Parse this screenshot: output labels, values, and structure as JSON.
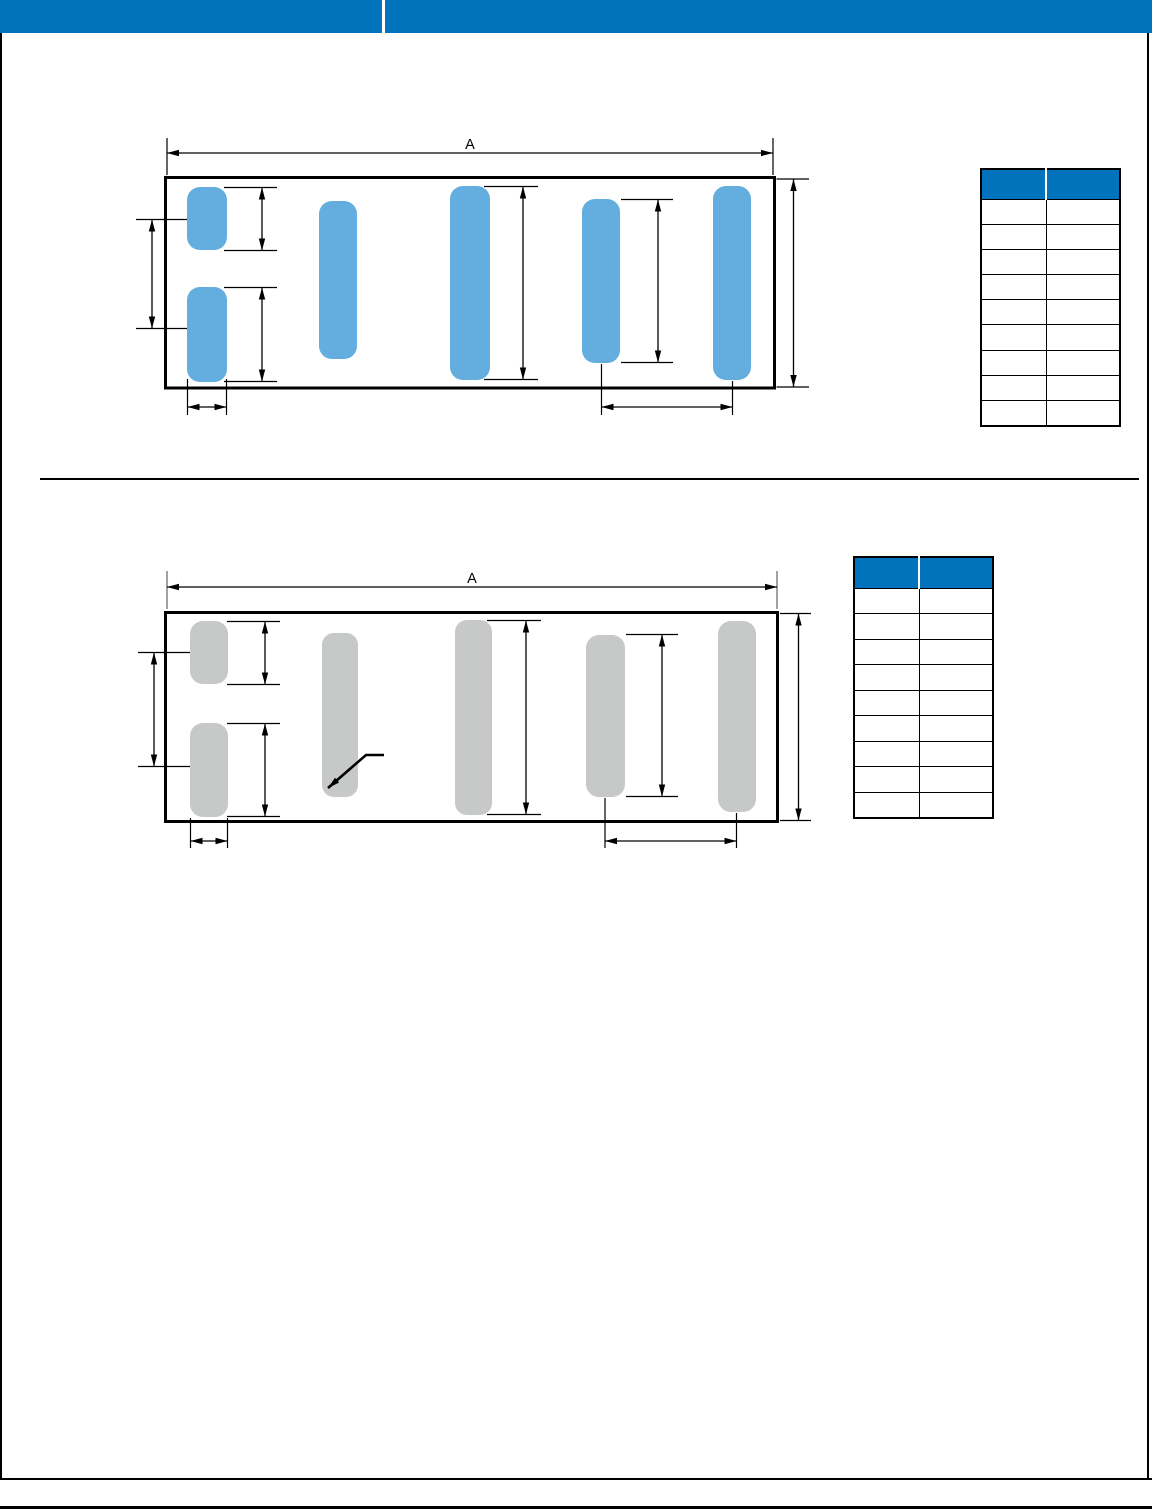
{
  "colors": {
    "brand-blue": "#0073BC",
    "pad-blue": "#63ADDF",
    "pad-gray": "#C7C8C8",
    "line": "#000000",
    "line-gray": "#A2A2A2"
  },
  "diagram_top": {
    "dim_label": "A"
  },
  "diagram_bottom": {
    "dim_label": "A"
  },
  "table_top": {
    "columns": [
      "",
      ""
    ],
    "rows": [
      [
        "",
        ""
      ],
      [
        "",
        ""
      ],
      [
        "",
        ""
      ],
      [
        "",
        ""
      ],
      [
        "",
        ""
      ],
      [
        "",
        ""
      ],
      [
        "",
        ""
      ],
      [
        "",
        ""
      ],
      [
        "",
        ""
      ]
    ]
  },
  "table_bottom": {
    "columns": [
      "",
      ""
    ],
    "rows": [
      [
        "",
        ""
      ],
      [
        "",
        ""
      ],
      [
        "",
        ""
      ],
      [
        "",
        ""
      ],
      [
        "",
        ""
      ],
      [
        "",
        ""
      ],
      [
        "",
        ""
      ],
      [
        "",
        ""
      ],
      [
        "",
        ""
      ]
    ]
  }
}
